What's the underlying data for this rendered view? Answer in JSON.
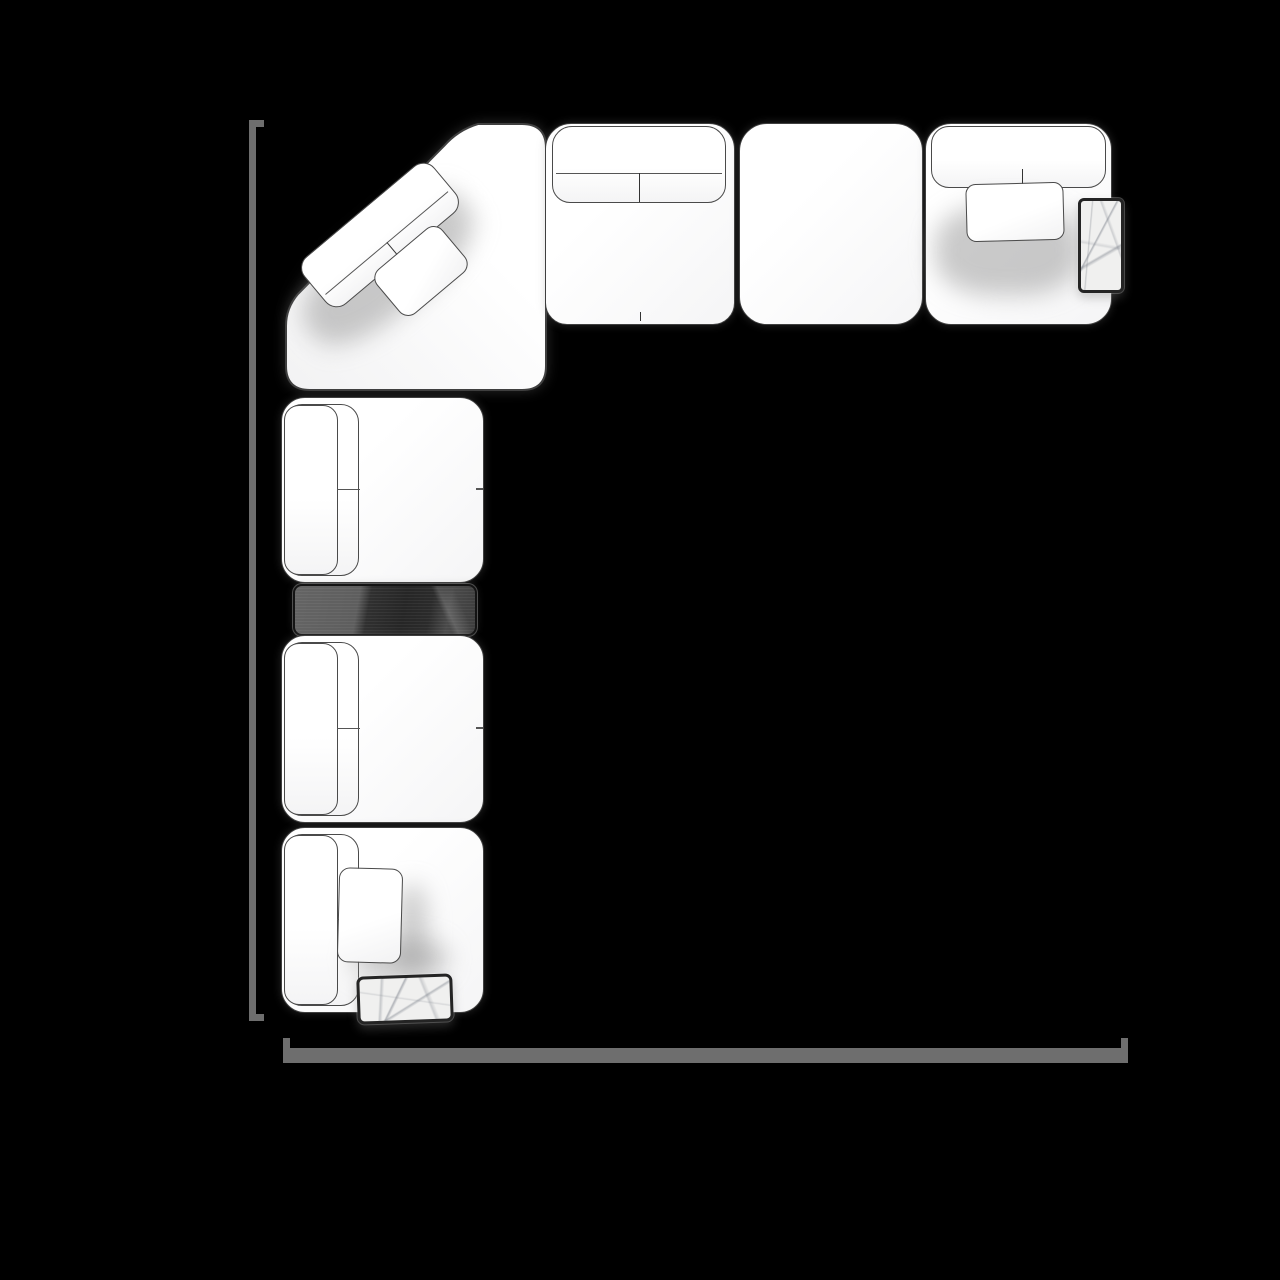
{
  "scene": {
    "type": "sectional-sofa-floorplan-top-view",
    "background_color": "#000000",
    "outline_color": "#3f3f3f",
    "upholstery_color": "#fbfbfc",
    "wall_line_color": "#6e6e6e",
    "console_color": "#2c2c2c",
    "marble_color": "#f0f0ef"
  },
  "modules": {
    "corner": {
      "label": "Corner seat module with two angled back cushions"
    },
    "top_row": [
      {
        "label": "Armless seat module with split back cushion"
      },
      {
        "label": "Backless ottoman module"
      },
      {
        "label": "Seat module with throw pillow and marble side table"
      }
    ],
    "left_column": [
      {
        "label": "Armless seat module, back cushion left"
      },
      {
        "label": "Dark console table module"
      },
      {
        "label": "Armless seat module, back cushion left"
      },
      {
        "label": "End seat module with throw pillow and marble tray table"
      }
    ],
    "accessories": {
      "corner_back_cushion_label": "Angled back cushion",
      "corner_pillow_label": "Angled throw pillow",
      "side_table_label": "Marble side table",
      "tray_table_label": "Marble tray table",
      "pillow_top_label": "Throw pillow",
      "pillow_bottom_label": "Throw pillow"
    },
    "walls": {
      "left_label": "Left wall line",
      "bottom_label": "Bottom wall line"
    }
  }
}
